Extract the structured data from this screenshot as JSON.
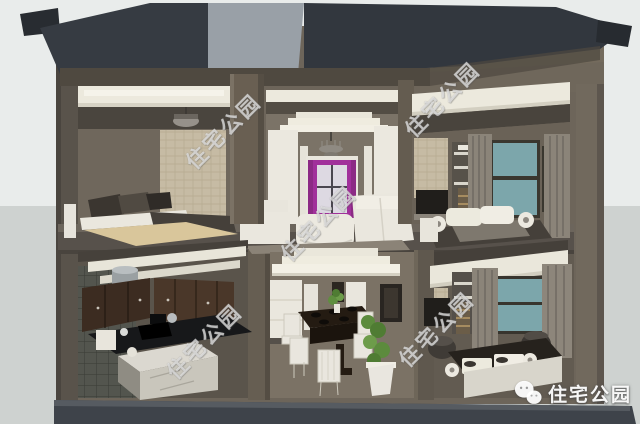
{
  "scene": {
    "type": "3d-architectural-cutaway-render",
    "subject": "two-story-residence-cross-section",
    "rooms": [
      "master-bedroom",
      "living-room",
      "bedroom-upper-right",
      "kitchen",
      "dining-room",
      "bedroom-lower-right"
    ]
  },
  "watermarks": {
    "brand_text": "住宅公园",
    "diagonal_instances": [
      {
        "x": 163,
        "y": 116
      },
      {
        "x": 258,
        "y": 208
      },
      {
        "x": 382,
        "y": 84
      },
      {
        "x": 144,
        "y": 326
      },
      {
        "x": 376,
        "y": 314
      }
    ],
    "logo": {
      "icon": "wechat-icon",
      "text": "住宅公园"
    }
  },
  "palette": {
    "background_top": "#e9eceb",
    "background_bottom": "#ced2d0",
    "roof_dark": "#343a41",
    "roof_light": "#99a0a7",
    "wall_brown": "#6d655a",
    "wall_cut_dark": "#59534b",
    "molding_white": "#ece9dd",
    "slab_brown": "#57514b",
    "foundation_gray": "#3e434a",
    "window_magenta": "#a1309b",
    "window_teal": "#7ca6ab",
    "curtain_taupe": "#8b8479",
    "cabinet_brown": "#3c2c21",
    "counter_black": "#17181a",
    "plant_green": "#5f8e3f",
    "accent_red_cushion": "#7c2732",
    "bed_tan": "#d9c69b"
  }
}
